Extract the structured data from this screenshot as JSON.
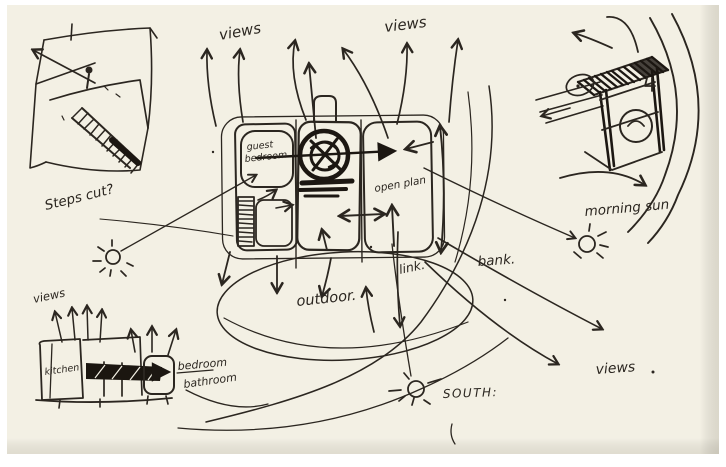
{
  "canvas": {
    "paper_color": "#f3f0e4",
    "ink_color": "#2b2620",
    "heavy_ink_color": "#1c1712",
    "border_color": "#ffffff"
  },
  "labels": {
    "views_top_left": "views",
    "views_top_right": "views",
    "steps_cut": "Steps cut?",
    "guest_bedroom_line1": "guest",
    "guest_bedroom_line2": "bedroom",
    "open_plan": "open plan",
    "morning_sun": "morning sun",
    "outdoor": "outdoor.",
    "link": "link.",
    "bank": "bank.",
    "south": "SOUTH:",
    "views_bottom_right": "views",
    "views_bottom_left": "views",
    "kitchen": "kitchen",
    "bedroom": "bedroom",
    "bathroom": "bathroom"
  }
}
